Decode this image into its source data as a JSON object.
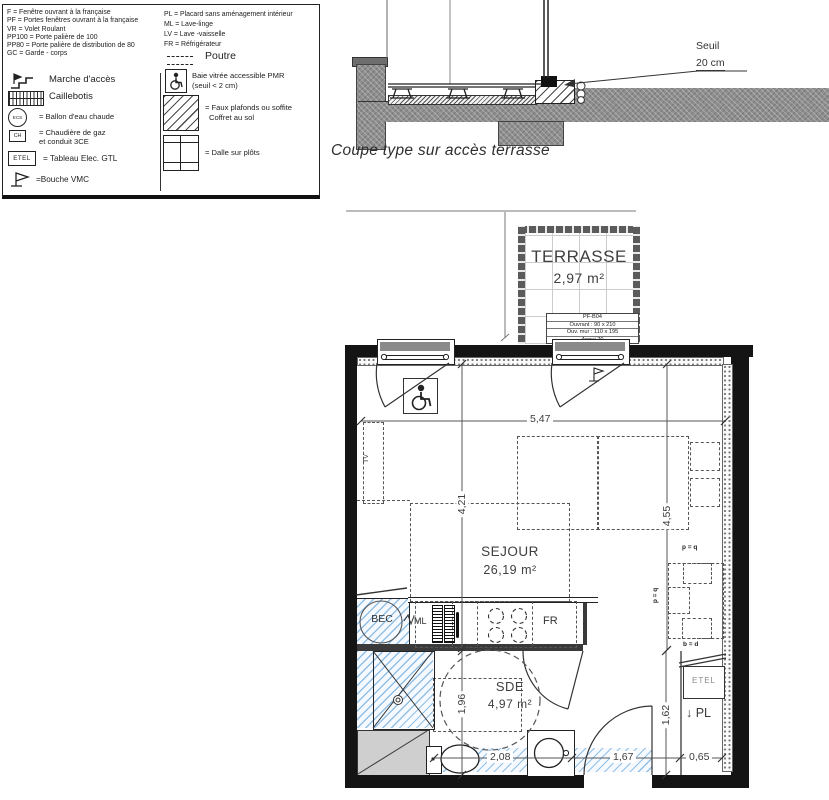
{
  "colors": {
    "wall": "#141414",
    "line": "#333333",
    "dash": "#555555",
    "blue_hatch": "#7db4e4",
    "concrete": "#8f8f8f"
  },
  "legend": {
    "abbr_left": [
      "F = Fenêtre ouvrant à la française",
      "PF = Portes fenêtres ouvrant à la française",
      "VR = Volet Roulant",
      "PP100 = Porte palière de 100",
      "PP80 = Porte palière de distribution de 80",
      "GC = Garde - corps"
    ],
    "abbr_right": [
      "PL = Placard sans aménagement intérieur",
      "ML = Lave-linge",
      "LV = Lave -vaisselle",
      "FR = Réfrigérateur"
    ],
    "marche": "Marche d'accès",
    "caillebotis": "Caillebotis",
    "ecs_badge": "ECS",
    "ecs": "= Ballon d'eau chaude",
    "ch_badge": "CH",
    "ch_1": "= Chaudière de gaz",
    "ch_2": "et conduit 3CE",
    "etel_badge": "ETEL",
    "etel": "= Tableau Elec. GTL",
    "vmc": "=Bouche VMC",
    "poutre": "Poutre",
    "pmr_1": "Baie vitrée accessible PMR",
    "pmr_2": "(seuil < 2 cm)",
    "faux_1": "= Faux plafonds ou soffite",
    "faux_2": "Coffret au sol",
    "dalle": "= Dalle sur plôts"
  },
  "section": {
    "seuil": "Seuil",
    "seuil_value": "20 cm",
    "caption": "Coupe type sur accès terrasse"
  },
  "terrace": {
    "name": "TERRASSE",
    "area": "2,97 m²",
    "ref": "PF-B04",
    "l1": "Ouvrant :  90 x 210",
    "l2": "Ouv. mur :  110 x 195",
    "l3": "Appui  20"
  },
  "plan": {
    "sejour": "SEJOUR",
    "sejour_area": "26,19 m²",
    "sde": "SDE",
    "sde_area": "4,97 m²",
    "tv": "TV",
    "bec": "BEC",
    "ml": "ML",
    "fr": "FR",
    "etel": "ETEL",
    "pl": "↓ PL",
    "pq_top": "p = q",
    "pq_side": "p = q",
    "bd": "b = d",
    "d_547": "5,47",
    "d_421": "4,21",
    "d_455": "4,55",
    "d_196": "1,96",
    "d_162": "1,62",
    "d_208": "2,08",
    "d_167": "1,67",
    "d_065": "0,65"
  }
}
